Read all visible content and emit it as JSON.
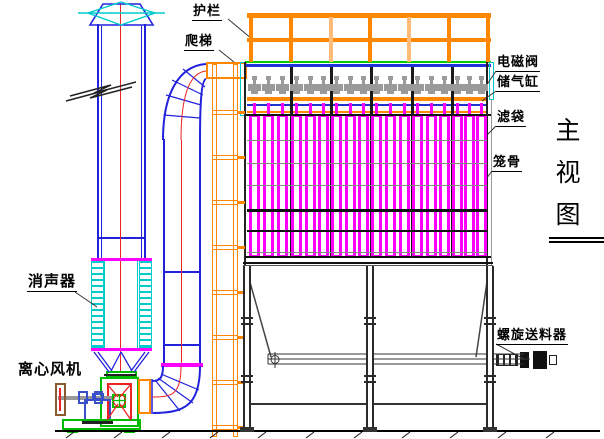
{
  "drawing": {
    "view_title": "主视图",
    "view_title_chars": [
      "主",
      "视",
      "图"
    ],
    "labels": {
      "guardrail": "护栏",
      "ladder": "爬梯",
      "solenoid_valve": "电磁阀",
      "air_reservoir": "储气缸",
      "filter_bag": "滤袋",
      "bag_cage": "笼骨",
      "muffler": "消声器",
      "centrifugal_fan": "离心风机",
      "screw_discharger": "螺旋送料器"
    },
    "colors": {
      "duct_blue": "#2222dd",
      "cyan": "#00cccc",
      "centerline_red": "#ee2222",
      "bag_magenta": "#ff00ff",
      "structure_orange": "#ff8800",
      "light_orange": "#ffbb77",
      "green": "#00bb00",
      "valve_gray": "#9a9a9a",
      "line_black": "#000000"
    },
    "structure": {
      "compartment_count": 6,
      "valves_per_compartment": 3,
      "bags_per_compartment": 3,
      "solenoid_valve_count": 18,
      "railing_post_count": 7,
      "ladder_rung_count": 8
    }
  }
}
